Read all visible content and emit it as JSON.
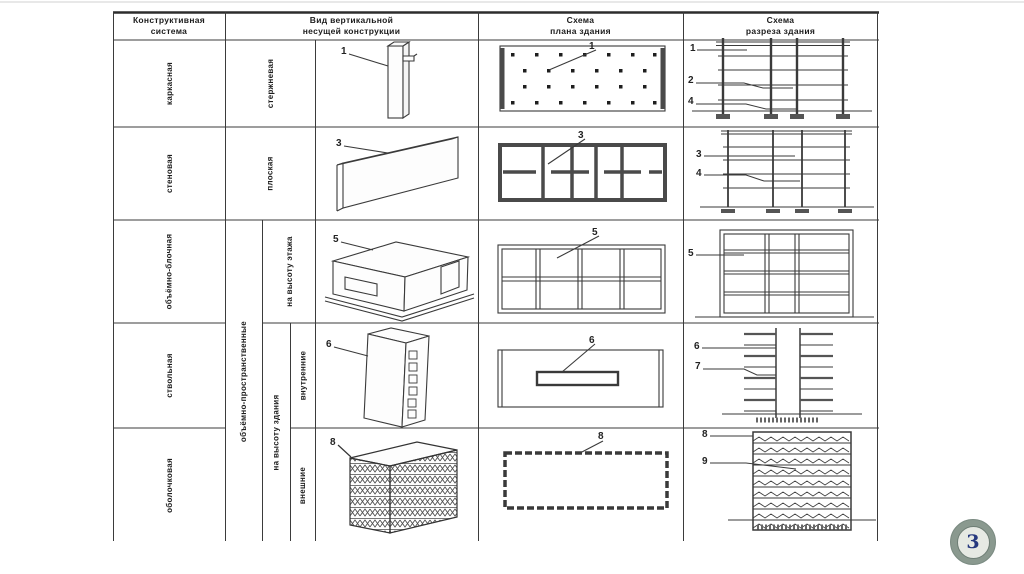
{
  "slide": {
    "page_number": "3"
  },
  "table": {
    "headers": {
      "system": "Конструктивная\nсистема",
      "vertical_structure": "Вид вертикальной\nнесущей конструкции",
      "plan": "Схема\nплана здания",
      "section": "Схема\nразреза здания"
    },
    "systems": {
      "r1": "каркасная",
      "r2": "стеновая",
      "r3": "объёмно-блочная",
      "r4": "ствольная",
      "r5": "оболочковая"
    },
    "types": {
      "r1": "стержневая",
      "r2": "плоская",
      "group": "объёмно-пространственные",
      "r3": "на высоту этажа",
      "r45": "на высоту здания",
      "r4": "внутренние",
      "r5": "внешние"
    },
    "figure_labels": {
      "r1_axon": "1",
      "r1_plan": "1",
      "r1_sec_a": "1",
      "r1_sec_b": "2",
      "r1_sec_c": "4",
      "r2_axon": "3",
      "r2_plan": "3",
      "r2_sec_a": "3",
      "r2_sec_b": "4",
      "r3_axon": "5",
      "r3_plan": "5",
      "r3_sec_a": "5",
      "r4_axon": "6",
      "r4_plan": "6",
      "r4_sec_a": "6",
      "r4_sec_b": "7",
      "r5_axon": "8",
      "r5_plan": "8",
      "r5_sec_a": "8",
      "r5_sec_b": "9"
    }
  },
  "colors": {
    "table_line": "#3b3b3b",
    "badge_ring": "#8a998f",
    "badge_number": "#26387e"
  }
}
